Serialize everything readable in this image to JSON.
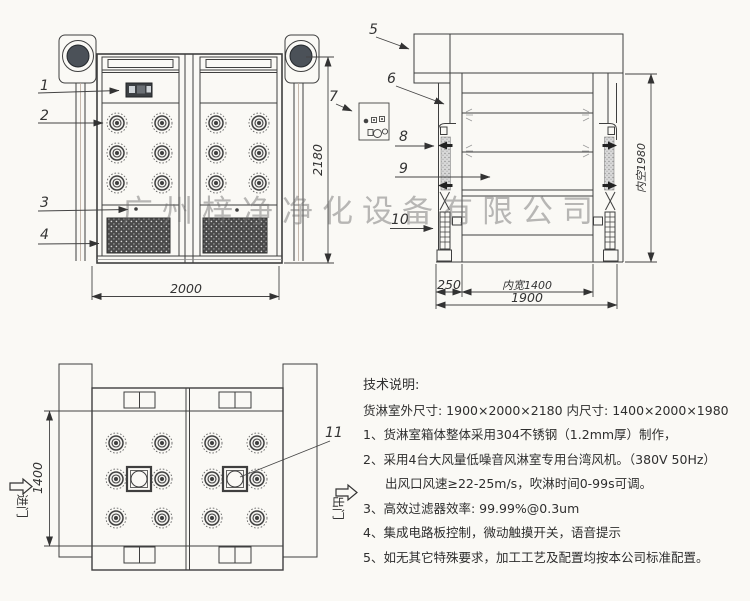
{
  "watermark": "广州梓净净化设备有限公司",
  "labels": {
    "l1": "1",
    "l2": "2",
    "l3": "3",
    "l4": "4",
    "l5": "5",
    "l6": "6",
    "l7": "7",
    "l8": "8",
    "l9": "9",
    "l10": "10",
    "l11": "11"
  },
  "dims": {
    "front_width": "2000",
    "front_height": "2180",
    "side_left": "250",
    "side_inner_width": "内宽1400",
    "side_total": "1900",
    "side_inner_height": "内空1980",
    "plan_depth": "1400"
  },
  "plan": {
    "entrance": "进门",
    "exit": "出门"
  },
  "notes": {
    "title": "技术说明:",
    "size_line": "货淋室外尺寸: 1900×2000×2180  内尺寸: 1400×2000×1980",
    "items": [
      "1、货淋室箱体整体采用304不锈钢（1.2mm厚）制作，",
      "2、采用4台大风量低噪音风淋室专用台湾风机。（380V 50Hz）",
      "出风口风速≥22-25m/s，吹淋时间0-99s可调。",
      "3、高效过滤器效率: 99.99%@0.3um",
      "4、集成电路板控制，微动触摸开关，语音提示",
      "5、如无其它特殊要求，加工工艺及配置均按本公司标准配置。"
    ]
  }
}
